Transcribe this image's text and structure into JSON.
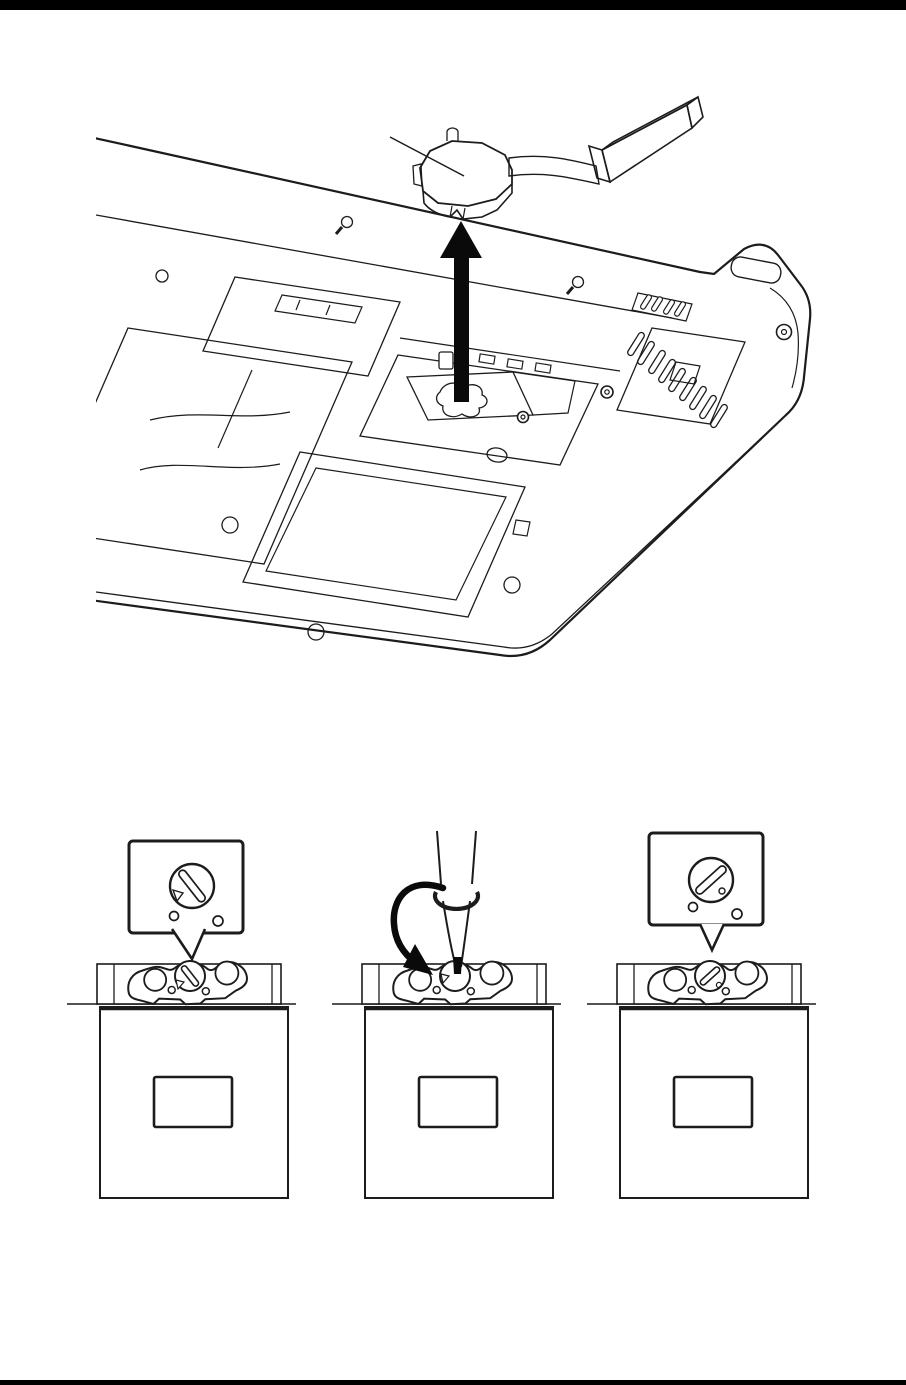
{
  "page": {
    "kind": "service-manual illustration page",
    "background": "#ffffff",
    "rule_color": "#000000"
  },
  "colors": {
    "line": "#1c1c1c",
    "heatsink_plate": "#bdc1c5",
    "heatsink_pipe": "#caced2",
    "fin_front": "#c3c7cb",
    "fin_top": "#e4e6e8",
    "fin_end": "#d6d8da",
    "socket_body": "#d0d0d0",
    "arrow_black": "#0a0a0a"
  },
  "top_figure": {
    "subject": "cooling module removal from laptop bottom",
    "component": "cooling module (contact plate, heat pipe, fin block)",
    "action": "lift straight up",
    "arrow_direction": "up",
    "arrow_fill": "#0a0a0a",
    "leader_line": "points to cooling module plate"
  },
  "socket_figures": {
    "left": {
      "state": "cam unlock position",
      "slot_angle_deg": 52,
      "marker": "triangle",
      "has_callout": true,
      "slot_transform_callout": "translate(192,886) rotate(52)",
      "slot_transform_bar": "translate(190,976) rotate(52)"
    },
    "middle": {
      "state": "turning cam screw",
      "tool": "flat-blade screwdriver",
      "rotation": "counterclockwise",
      "has_callout": false
    },
    "right": {
      "state": "cam lock position",
      "slot_angle_deg": -42,
      "marker": "dot",
      "has_callout": true,
      "slot_transform_callout": "translate(711,880) rotate(-42)",
      "slot_transform_bar": "translate(710,976) rotate(-42)"
    }
  }
}
